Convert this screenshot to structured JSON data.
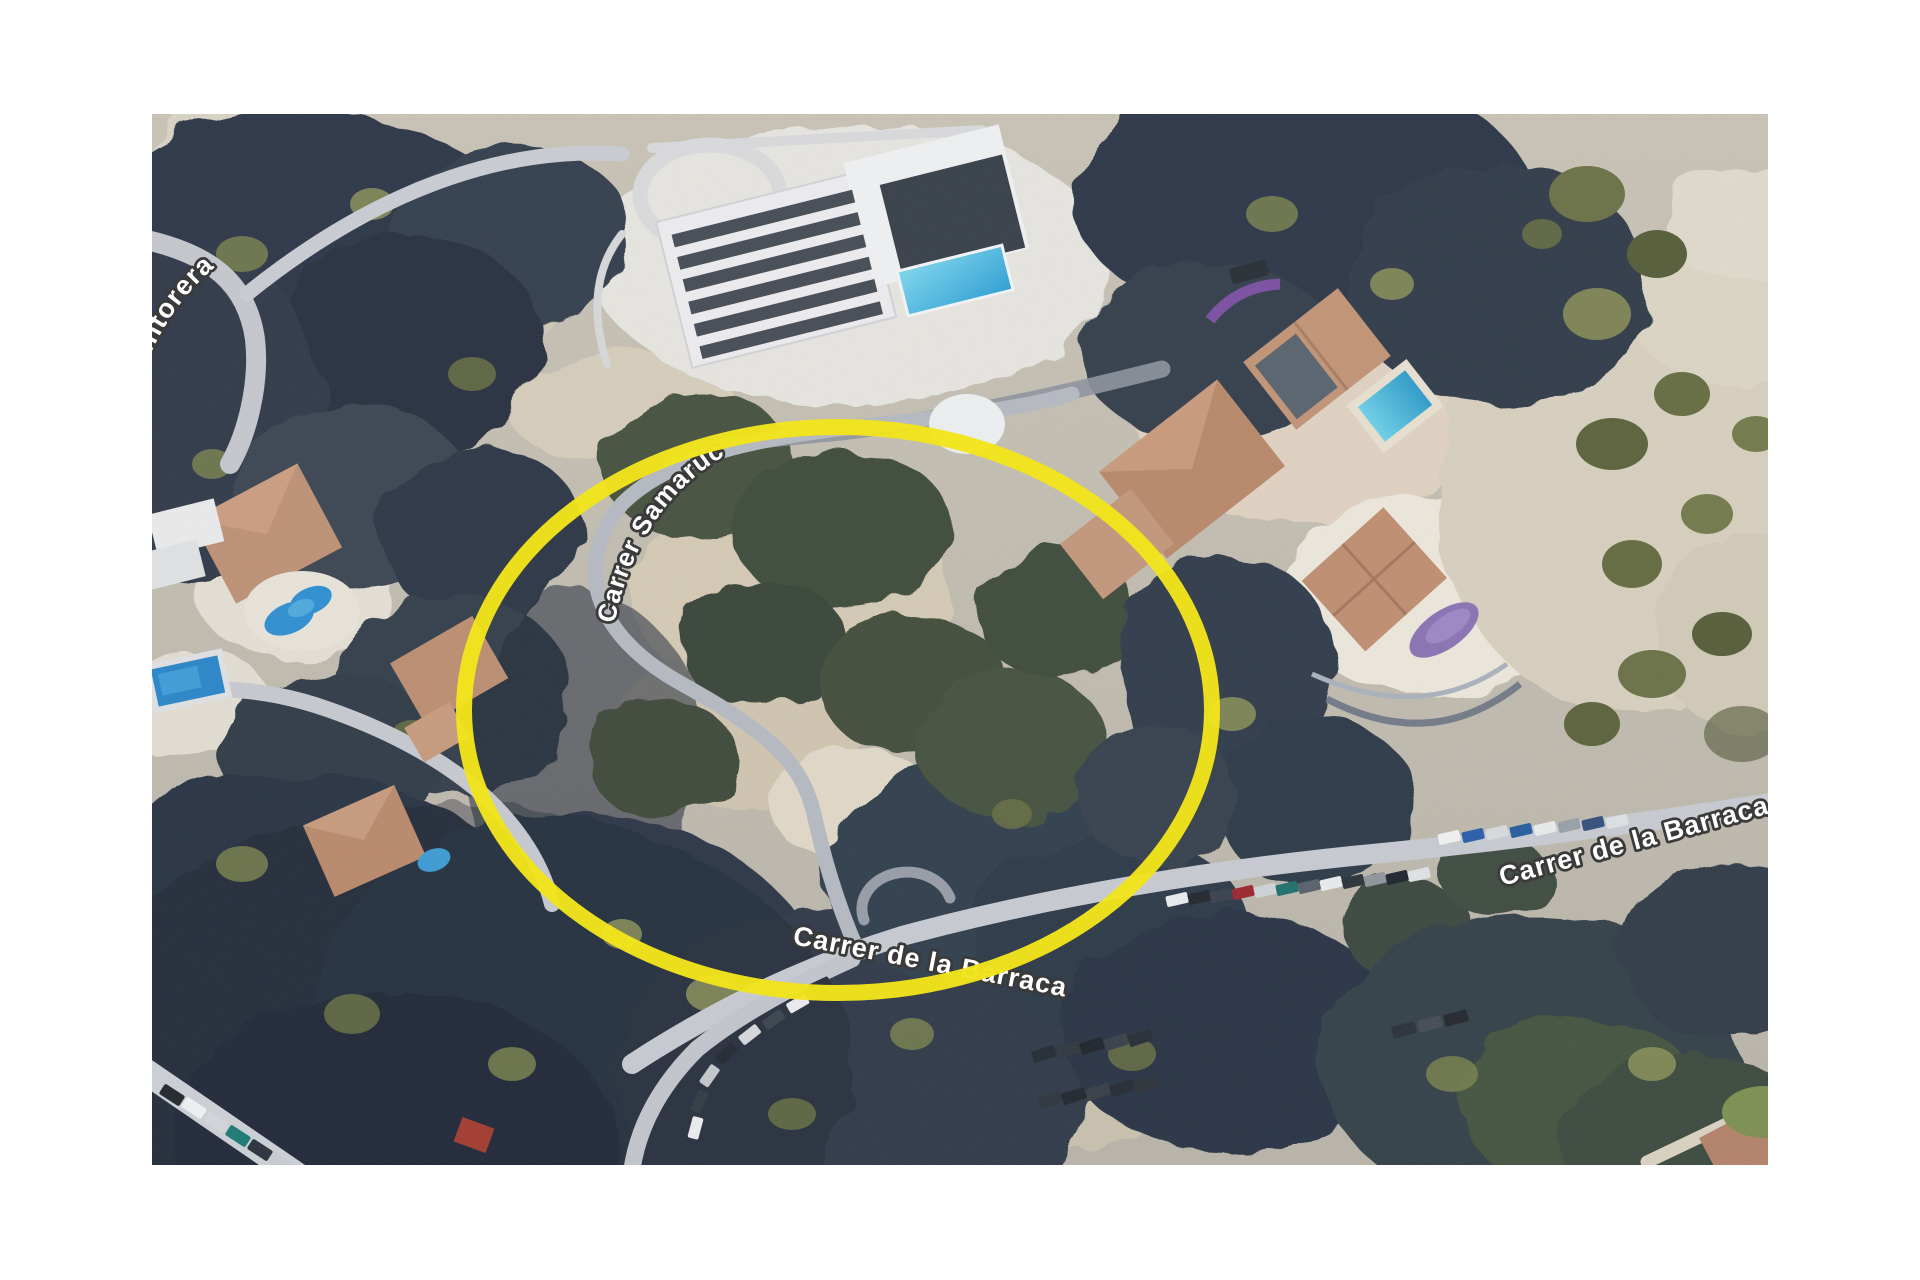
{
  "window": {
    "width": 1920,
    "height": 1280,
    "background": "#ffffff"
  },
  "map": {
    "kind": "aerial-satellite-imagery",
    "area": {
      "left": 152,
      "top": 114,
      "width": 1616,
      "height": 1051
    },
    "road_labels": [
      {
        "id": "calle-tintorera",
        "text": "Calle Tintorera"
      },
      {
        "id": "carrer-samaruc",
        "text": "Carrer Samaruc"
      },
      {
        "id": "carrer-de-la-barraca-east",
        "text": "Carrer de la Barraca"
      },
      {
        "id": "carrer-de-la-barraca-south",
        "text": "Carrer de la Barraca"
      }
    ],
    "annotation": {
      "shape": "ellipse",
      "purpose": "highlighted-plot-of-land",
      "color": "#f2e41c",
      "center_x": 838,
      "center_y": 710,
      "radius_x": 374,
      "radius_y": 283,
      "stroke_width": 16
    },
    "label_style": {
      "fill": "#ffffff",
      "outline": "#3a3a3a"
    },
    "palette": {
      "vegetation_dark": "#2e3848",
      "vegetation_green": "#46523f",
      "vegetation_olive": "#7c8152",
      "sand": "#d9d0bc",
      "road": "#c7cad1",
      "roof_terracotta": "#bd9176",
      "building_white": "#eceef0",
      "pool_blue": "#2f8fd0",
      "pool_cyan": "#5ec9e6",
      "pool_purple": "#8a73b4"
    }
  }
}
